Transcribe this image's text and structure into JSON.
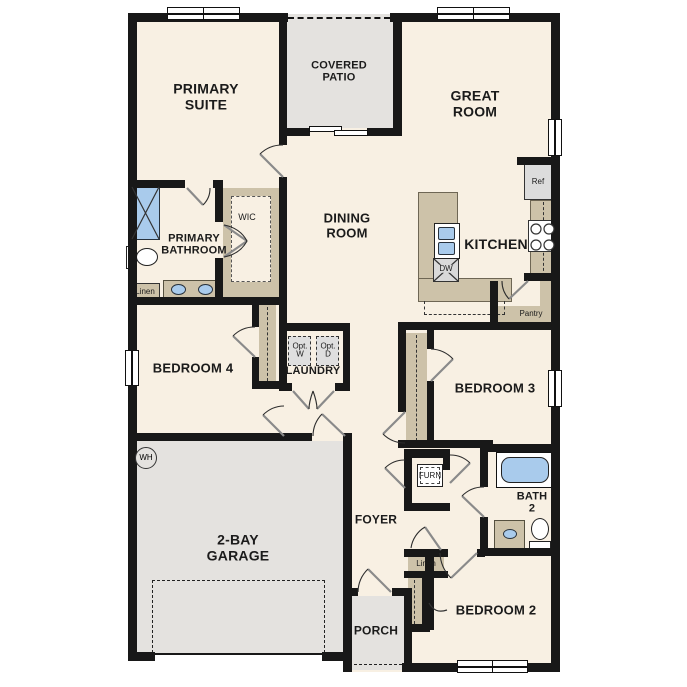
{
  "colors": {
    "wall": "#181818",
    "floor": "#f8f0e3",
    "outdoor_floor": "#e4e2df",
    "cabinet": "#cdc2a9",
    "fixture_blue": "#a9cbec",
    "appliance": "#dcdcdc"
  },
  "labels": {
    "covered_patio": "COVERED\nPATIO",
    "primary_suite": "PRIMARY\nSUITE",
    "great_room": "GREAT\nROOM",
    "dining_room": "DINING\nROOM",
    "kitchen": "KITCHEN",
    "primary_bathroom": "PRIMARY\nBATHROOM",
    "wic": "WIC",
    "linen_primary": "Linen",
    "bedroom4": "BEDROOM 4",
    "laundry": "LAUNDRY",
    "opt_washer": "Opt.\nW",
    "opt_dryer": "Opt.\nD",
    "garage": "2-BAY\nGARAGE",
    "foyer": "FOYER",
    "furnace": "FURN",
    "bedroom3": "BEDROOM 3",
    "bath2": "BATH\n2",
    "bedroom2": "BEDROOM 2",
    "linen_foyer": "Linen",
    "porch": "PORCH",
    "pantry": "Pantry",
    "refrigerator": "Ref",
    "dishwasher": "DW",
    "water_heater": "WH"
  }
}
